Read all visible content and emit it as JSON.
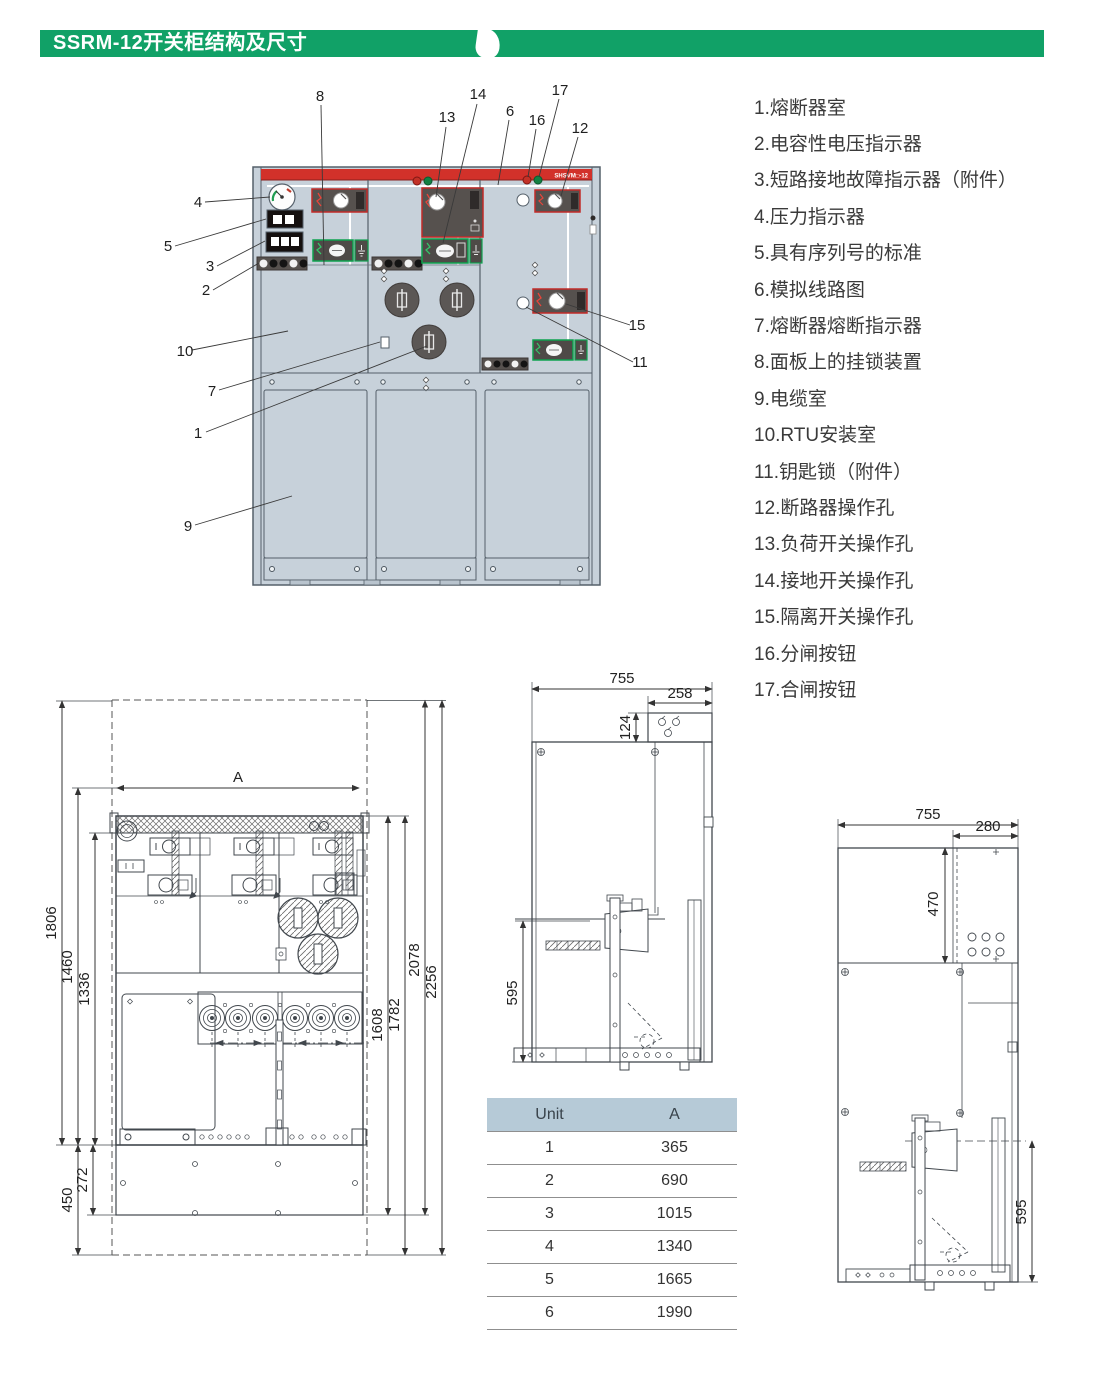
{
  "header": {
    "title": "SSRM-12开关柜结构及尺寸"
  },
  "front_view": {
    "model_label": "SHSVM□-12",
    "callouts": {
      "n1": "1",
      "n2": "2",
      "n3": "3",
      "n4": "4",
      "n5": "5",
      "n6": "6",
      "n7": "7",
      "n8": "8",
      "n9": "9",
      "n10": "10",
      "n11": "11",
      "n12": "12",
      "n13": "13",
      "n14": "14",
      "n15": "15",
      "n16": "16",
      "n17": "17"
    }
  },
  "legend": {
    "items": [
      "1.熔断器室",
      "2.电容性电压指示器",
      "3.短路接地故障指示器（附件）",
      "4.压力指示器",
      "5.具有序列号的标准",
      "6.模拟线路图",
      "7.熔断器熔断指示器",
      "8.面板上的挂锁装置",
      "9.电缆室",
      "10.RTU安装室",
      "11.钥匙锁（附件）",
      "12.断路器操作孔",
      "13.负荷开关操作孔",
      "14.接地开关操作孔",
      "15.隔离开关操作孔",
      "16.分闸按钮",
      "17.合闸按钮"
    ]
  },
  "dim_front": {
    "a_label": "A",
    "h1806": "1806",
    "h1460": "1460",
    "h1336": "1336",
    "h450": "450",
    "h272": "272",
    "h1608": "1608",
    "h1782": "1782",
    "h2078": "2078",
    "h2256": "2256"
  },
  "dim_side1": {
    "w755": "755",
    "w258": "258",
    "h124": "124",
    "h595": "595"
  },
  "dim_side2": {
    "w755": "755",
    "w280": "280",
    "h470": "470",
    "h595": "595"
  },
  "table": {
    "headers": [
      "Unit",
      "A"
    ],
    "rows": [
      [
        "1",
        "365"
      ],
      [
        "2",
        "690"
      ],
      [
        "3",
        "1015"
      ],
      [
        "4",
        "1340"
      ],
      [
        "5",
        "1665"
      ],
      [
        "6",
        "1990"
      ]
    ]
  },
  "colors": {
    "accent_green": "#11a167",
    "cabinet_body": "#c7d1da",
    "cabinet_red_band": "#d2312a",
    "module_red_frame": "#c22b28",
    "module_green_frame": "#0fa24f",
    "table_header_bg": "#b6cad7"
  }
}
